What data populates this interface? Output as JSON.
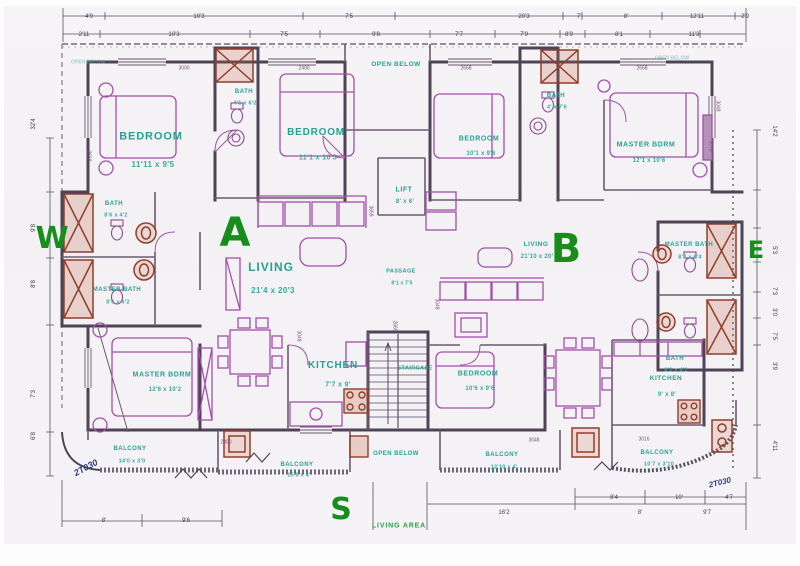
{
  "title": "Apartment floor plan - Units A and B",
  "colors": {
    "paper": "#f4f2f5",
    "wall": "#4f4455",
    "furniture": "#a050a8",
    "fixture_brown": "#8e3f2c",
    "room_label_teal": "#2ba093",
    "unit_letter_green": "#1b8c20",
    "tag_navy": "#30407f",
    "dimension_gray": "#3f3f4e"
  },
  "units": {
    "a": "A",
    "b": "B"
  },
  "compass": {
    "west": "W",
    "east": "E",
    "south": "S"
  },
  "plan": {
    "labels": [
      {
        "n": "room-label-bedroom-a1",
        "t": "BEDROOM",
        "x": 147,
        "y": 131,
        "s": 11
      },
      {
        "n": "room-dim-bedroom-a1",
        "t": "11'11 x 9'5",
        "x": 149,
        "y": 159,
        "s": 8,
        "c": "rdim"
      },
      {
        "n": "room-label-bedroom-a2",
        "t": "BEDROOM",
        "x": 312,
        "y": 127,
        "s": 10
      },
      {
        "n": "room-dim-bedroom-a2",
        "t": "11'1 x 10'5",
        "x": 314,
        "y": 152,
        "s": 7,
        "c": "rdim"
      },
      {
        "n": "room-label-bedroom-b1",
        "t": "BEDROOM",
        "x": 475,
        "y": 133,
        "s": 7
      },
      {
        "n": "room-dim-bedroom-b1",
        "t": "10'1 x 9'6",
        "x": 477,
        "y": 148,
        "s": 6,
        "c": "rdim"
      },
      {
        "n": "room-label-master-bdrm-b",
        "t": "MASTER BDRM",
        "x": 642,
        "y": 139,
        "s": 7
      },
      {
        "n": "room-dim-master-bdrm-b",
        "t": "12'1 x 10'6",
        "x": 645,
        "y": 155,
        "s": 6,
        "c": "rdim"
      },
      {
        "n": "room-label-master-bdrm-a",
        "t": "MASTER BDRM",
        "x": 158,
        "y": 369,
        "s": 7
      },
      {
        "n": "room-dim-master-bdrm-a",
        "t": "12'6 x 10'2",
        "x": 161,
        "y": 384,
        "s": 6,
        "c": "rdim"
      },
      {
        "n": "room-label-bedroom-b2",
        "t": "BEDROOM",
        "x": 474,
        "y": 368,
        "s": 7
      },
      {
        "n": "room-dim-bedroom-b2",
        "t": "10'6 x 9'6",
        "x": 476,
        "y": 383,
        "s": 6,
        "c": "rdim"
      },
      {
        "n": "room-label-living-a",
        "t": "LIVING",
        "x": 267,
        "y": 261,
        "s": 12
      },
      {
        "n": "room-dim-living-a",
        "t": "21'4 x 20'3",
        "x": 269,
        "y": 285,
        "s": 8,
        "c": "rdim"
      },
      {
        "n": "room-label-living-b",
        "t": "LIVING",
        "x": 532,
        "y": 239,
        "s": 6.5
      },
      {
        "n": "room-dim-living-b",
        "t": "21'10 x 20'",
        "x": 533,
        "y": 251,
        "s": 6,
        "c": "rdim"
      },
      {
        "n": "room-label-kitchen-a",
        "t": "KITCHEN",
        "x": 329,
        "y": 360,
        "s": 10
      },
      {
        "n": "room-dim-kitchen-a",
        "t": "7'7 x 9'",
        "x": 334,
        "y": 379,
        "s": 7,
        "c": "rdim"
      },
      {
        "n": "room-label-kitchen-b",
        "t": "KITCHEN",
        "x": 662,
        "y": 373,
        "s": 6.5
      },
      {
        "n": "room-dim-kitchen-b",
        "t": "9' x 8'",
        "x": 663,
        "y": 389,
        "s": 6,
        "c": "rdim"
      },
      {
        "n": "room-label-lift",
        "t": "LIFT",
        "x": 400,
        "y": 184,
        "s": 7
      },
      {
        "n": "room-dim-lift",
        "t": "8' x 6'",
        "x": 401,
        "y": 196,
        "s": 6,
        "c": "rdim"
      },
      {
        "n": "room-label-bath-a",
        "t": "BATH",
        "x": 240,
        "y": 86,
        "s": 6
      },
      {
        "n": "room-dim-bath-a",
        "t": "4'1 x 6'2",
        "x": 241,
        "y": 98,
        "s": 5.5,
        "c": "rdim"
      },
      {
        "n": "room-label-bath-b",
        "t": "BATH",
        "x": 552,
        "y": 90,
        "s": 6
      },
      {
        "n": "room-dim-bath-b",
        "t": "4' x 7'6",
        "x": 553,
        "y": 102,
        "s": 5.5,
        "c": "rdim"
      },
      {
        "n": "room-label-bath-w",
        "t": "BATH",
        "x": 110,
        "y": 198,
        "s": 6
      },
      {
        "n": "room-dim-bath-w",
        "t": "8'6 x 4'2",
        "x": 112,
        "y": 210,
        "s": 5.5,
        "c": "rdim"
      },
      {
        "n": "room-label-master-bath-w",
        "t": "MASTER BATH",
        "x": 113,
        "y": 284,
        "s": 6
      },
      {
        "n": "room-dim-master-bath-w",
        "t": "8'6 x 6'2",
        "x": 114,
        "y": 297,
        "s": 5.5,
        "c": "rdim"
      },
      {
        "n": "room-label-master-bath-e",
        "t": "MASTER BATH",
        "x": 685,
        "y": 239,
        "s": 6
      },
      {
        "n": "room-dim-master-bath-e",
        "t": "8'0 x 6'4",
        "x": 686,
        "y": 252,
        "s": 5.5,
        "c": "rdim"
      },
      {
        "n": "room-label-bath-e",
        "t": "BATH",
        "x": 671,
        "y": 353,
        "s": 6
      },
      {
        "n": "room-dim-bath-e",
        "t": "8'2 x 4'2",
        "x": 672,
        "y": 365,
        "s": 5.5,
        "c": "rdim"
      },
      {
        "n": "room-label-passage",
        "t": "PASSAGE",
        "x": 397,
        "y": 266,
        "s": 5.5
      },
      {
        "n": "room-dim-passage",
        "t": "8'1 x 7'5",
        "x": 398,
        "y": 278,
        "s": 5,
        "c": "rdim"
      },
      {
        "n": "room-label-open-below-top",
        "t": "OPEN BELOW",
        "x": 392,
        "y": 59,
        "s": 6.5
      },
      {
        "n": "room-label-open-below-bottom",
        "t": "OPEN BELOW",
        "x": 392,
        "y": 448,
        "s": 6
      },
      {
        "n": "room-label-open-below-corner-left",
        "t": "OPEN BELOW",
        "x": 84,
        "y": 57,
        "s": 5,
        "c": "faint"
      },
      {
        "n": "room-label-open-below-corner-right",
        "t": "OPEN BELOW",
        "x": 668,
        "y": 53,
        "s": 5,
        "c": "faint"
      },
      {
        "n": "room-label-staircase",
        "t": "STAIRCASE",
        "x": 411,
        "y": 363,
        "s": 5.5
      },
      {
        "n": "room-label-balcony-a1",
        "t": "BALCONY",
        "x": 126,
        "y": 443,
        "s": 6
      },
      {
        "n": "room-dim-balcony-a1",
        "t": "14'0 x 3'0",
        "x": 128,
        "y": 456,
        "s": 5.5,
        "c": "rdim"
      },
      {
        "n": "room-label-balcony-a2",
        "t": "BALCONY",
        "x": 293,
        "y": 459,
        "s": 6
      },
      {
        "n": "room-dim-balcony-a2",
        "t": "15'0 x 4'",
        "x": 295,
        "y": 470,
        "s": 5.5,
        "c": "rdim"
      },
      {
        "n": "room-label-balcony-b1",
        "t": "BALCONY",
        "x": 498,
        "y": 449,
        "s": 6
      },
      {
        "n": "room-dim-balcony-b1",
        "t": "12'10 x 4'",
        "x": 500,
        "y": 462,
        "s": 5.5,
        "c": "rdim"
      },
      {
        "n": "room-label-balcony-b2",
        "t": "BALCONY",
        "x": 653,
        "y": 447,
        "s": 6
      },
      {
        "n": "room-dim-balcony-b2",
        "t": "10'7 x 3'10",
        "x": 655,
        "y": 459,
        "s": 5.5,
        "c": "rdim"
      },
      {
        "n": "living-area-note",
        "t": "LIVING AREA",
        "x": 395,
        "y": 520,
        "s": 7,
        "c": "green2"
      },
      {
        "n": "unit-letter-a",
        "t": "A",
        "x": 231,
        "y": 227,
        "s": 40,
        "c": "letter"
      },
      {
        "n": "unit-letter-b",
        "t": "B",
        "x": 562,
        "y": 243,
        "s": 40,
        "c": "letter"
      },
      {
        "n": "compass-west",
        "t": "W",
        "x": 48,
        "y": 233,
        "s": 30,
        "c": "letter"
      },
      {
        "n": "compass-east",
        "t": "E",
        "x": 752,
        "y": 244,
        "s": 24,
        "c": "letter"
      },
      {
        "n": "compass-south",
        "t": "S",
        "x": 337,
        "y": 504,
        "s": 30,
        "c": "letter"
      },
      {
        "n": "window-tag-left",
        "t": "2T030",
        "x": 82,
        "y": 462,
        "s": 9,
        "c": "tag",
        "r": -28
      },
      {
        "n": "window-tag-right",
        "t": "2T030",
        "x": 716,
        "y": 477,
        "s": 8,
        "c": "tag",
        "r": -14
      },
      {
        "n": "dim-number",
        "t": "4'9",
        "x": 85,
        "y": 11,
        "s": 6,
        "c": "dim"
      },
      {
        "n": "dim-number",
        "t": "10'3",
        "x": 195,
        "y": 11,
        "s": 6,
        "c": "dim"
      },
      {
        "n": "dim-number",
        "t": "7'5",
        "x": 345,
        "y": 11,
        "s": 6,
        "c": "dim"
      },
      {
        "n": "dim-number",
        "t": "20'3",
        "x": 520,
        "y": 11,
        "s": 6,
        "c": "dim"
      },
      {
        "n": "dim-number",
        "t": "7'",
        "x": 575,
        "y": 11,
        "s": 6,
        "c": "dim"
      },
      {
        "n": "dim-number",
        "t": "8'",
        "x": 622,
        "y": 11,
        "s": 6,
        "c": "dim"
      },
      {
        "n": "dim-number",
        "t": "12'11",
        "x": 693,
        "y": 11,
        "s": 6,
        "c": "dim"
      },
      {
        "n": "dim-number",
        "t": "2'9",
        "x": 741,
        "y": 11,
        "s": 6,
        "c": "dim"
      },
      {
        "n": "dim-number",
        "t": "2'11",
        "x": 80,
        "y": 29,
        "s": 6,
        "c": "dim"
      },
      {
        "n": "dim-number",
        "t": "10'3",
        "x": 170,
        "y": 29,
        "s": 6,
        "c": "dim"
      },
      {
        "n": "dim-number",
        "t": "7'5",
        "x": 280,
        "y": 29,
        "s": 6,
        "c": "dim"
      },
      {
        "n": "dim-number",
        "t": "9'8",
        "x": 372,
        "y": 29,
        "s": 6,
        "c": "dim"
      },
      {
        "n": "dim-number",
        "t": "7'7",
        "x": 455,
        "y": 29,
        "s": 6,
        "c": "dim"
      },
      {
        "n": "dim-number",
        "t": "7'9",
        "x": 520,
        "y": 29,
        "s": 6,
        "c": "dim"
      },
      {
        "n": "dim-number",
        "t": "8'9",
        "x": 565,
        "y": 29,
        "s": 6,
        "c": "dim"
      },
      {
        "n": "dim-number",
        "t": "8'1",
        "x": 615,
        "y": 29,
        "s": 6,
        "c": "dim"
      },
      {
        "n": "dim-number",
        "t": "11'3",
        "x": 690,
        "y": 29,
        "s": 6,
        "c": "dim"
      },
      {
        "n": "dim-number",
        "t": "32'4",
        "x": 30,
        "y": 118,
        "s": 6,
        "c": "dim",
        "r": -90
      },
      {
        "n": "dim-number",
        "t": "9'8",
        "x": 30,
        "y": 222,
        "s": 6,
        "c": "dim",
        "r": -90
      },
      {
        "n": "dim-number",
        "t": "8'8",
        "x": 30,
        "y": 278,
        "s": 6,
        "c": "dim",
        "r": -90
      },
      {
        "n": "dim-number",
        "t": "7'3",
        "x": 30,
        "y": 388,
        "s": 6,
        "c": "dim",
        "r": -90
      },
      {
        "n": "dim-number",
        "t": "6'8",
        "x": 30,
        "y": 430,
        "s": 6,
        "c": "dim",
        "r": -90
      },
      {
        "n": "dim-number",
        "t": "14'2",
        "x": 770,
        "y": 125,
        "s": 6,
        "c": "dim",
        "r": 90
      },
      {
        "n": "dim-number",
        "t": "5'3",
        "x": 770,
        "y": 244,
        "s": 6,
        "c": "dim",
        "r": 90
      },
      {
        "n": "dim-number",
        "t": "7'3",
        "x": 770,
        "y": 285,
        "s": 6,
        "c": "dim",
        "r": 90
      },
      {
        "n": "dim-number",
        "t": "3'0",
        "x": 770,
        "y": 306,
        "s": 6,
        "c": "dim",
        "r": 90
      },
      {
        "n": "dim-number",
        "t": "7'5",
        "x": 770,
        "y": 330,
        "s": 6,
        "c": "dim",
        "r": 90
      },
      {
        "n": "dim-number",
        "t": "3'9",
        "x": 770,
        "y": 360,
        "s": 6,
        "c": "dim",
        "r": 90
      },
      {
        "n": "dim-number",
        "t": "4'11",
        "x": 770,
        "y": 440,
        "s": 6,
        "c": "dim",
        "r": 90
      },
      {
        "n": "dim-number",
        "t": "8'",
        "x": 100,
        "y": 515,
        "s": 6,
        "c": "dim"
      },
      {
        "n": "dim-number",
        "t": "9'6",
        "x": 182,
        "y": 515,
        "s": 6,
        "c": "dim"
      },
      {
        "n": "dim-number",
        "t": "8'4",
        "x": 610,
        "y": 492,
        "s": 6,
        "c": "dim"
      },
      {
        "n": "dim-number",
        "t": "10'",
        "x": 675,
        "y": 492,
        "s": 6,
        "c": "dim"
      },
      {
        "n": "dim-number",
        "t": "4'7",
        "x": 725,
        "y": 492,
        "s": 6,
        "c": "dim"
      },
      {
        "n": "dim-number",
        "t": "16'2",
        "x": 500,
        "y": 507,
        "s": 6,
        "c": "dim"
      },
      {
        "n": "dim-number",
        "t": "8'",
        "x": 636,
        "y": 507,
        "s": 6,
        "c": "dim"
      },
      {
        "n": "dim-number",
        "t": "9'7",
        "x": 703,
        "y": 507,
        "s": 6,
        "c": "dim"
      },
      {
        "n": "wall-tag",
        "t": "3000",
        "x": 180,
        "y": 63,
        "s": 5,
        "c": "wtag"
      },
      {
        "n": "wall-tag",
        "t": "2400",
        "x": 300,
        "y": 63,
        "s": 5,
        "c": "wtag"
      },
      {
        "n": "wall-tag",
        "t": "2668",
        "x": 462,
        "y": 63,
        "s": 5,
        "c": "wtag"
      },
      {
        "n": "wall-tag",
        "t": "2668",
        "x": 638,
        "y": 63,
        "s": 5,
        "c": "wtag"
      },
      {
        "n": "wall-tag",
        "t": "2668",
        "x": 84,
        "y": 150,
        "s": 5,
        "c": "wtag",
        "r": 90
      },
      {
        "n": "wall-tag",
        "t": "3658",
        "x": 366,
        "y": 205,
        "s": 5,
        "c": "wtag",
        "r": 90
      },
      {
        "n": "wall-tag",
        "t": "3048",
        "x": 432,
        "y": 298,
        "s": 5,
        "c": "wtag",
        "r": 90
      },
      {
        "n": "wall-tag",
        "t": "2668",
        "x": 390,
        "y": 320,
        "s": 5,
        "c": "wtag",
        "r": 90
      },
      {
        "n": "wall-tag",
        "t": "3048",
        "x": 294,
        "y": 330,
        "s": 5,
        "c": "wtag",
        "r": 90
      },
      {
        "n": "wall-tag",
        "t": "3078",
        "x": 706,
        "y": 140,
        "s": 5,
        "c": "wtag",
        "r": 90
      },
      {
        "n": "wall-tag",
        "t": "3048",
        "x": 713,
        "y": 100,
        "s": 5,
        "c": "wtag",
        "r": 90
      },
      {
        "n": "wall-tag",
        "t": "2400",
        "x": 222,
        "y": 437,
        "s": 5,
        "c": "wtag"
      },
      {
        "n": "wall-tag",
        "t": "3048",
        "x": 530,
        "y": 435,
        "s": 5,
        "c": "wtag"
      },
      {
        "n": "wall-tag",
        "t": "3016",
        "x": 640,
        "y": 434,
        "s": 5,
        "c": "wtag"
      }
    ]
  }
}
